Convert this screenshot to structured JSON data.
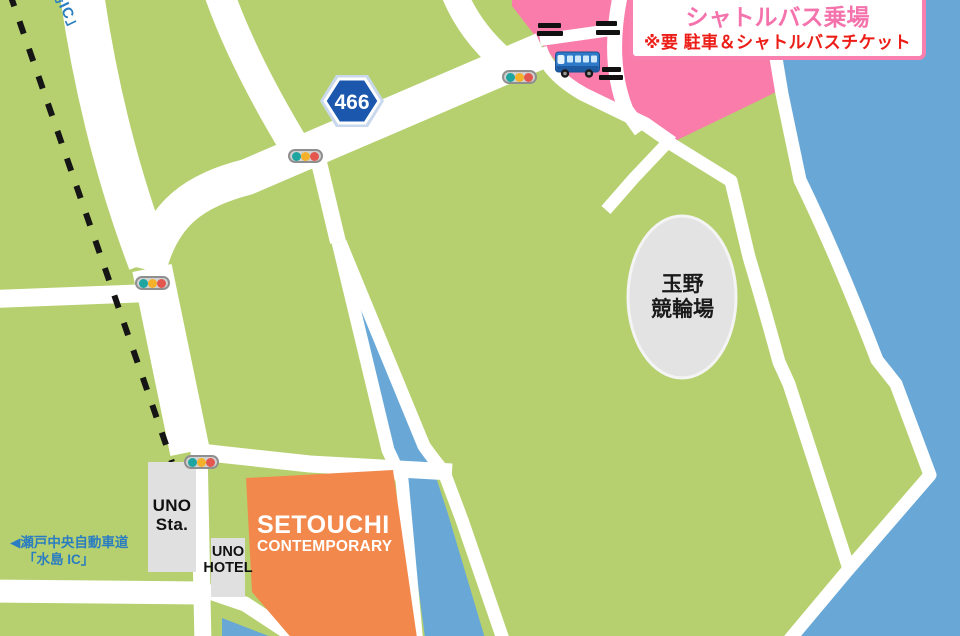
{
  "map": {
    "labels": {
      "route_number": "466",
      "ic_fragment": "島IC」",
      "expressway": {
        "line1": "◀瀬戸中央自動車道",
        "line2": "「水島 IC」"
      },
      "station": {
        "line1": "UNO",
        "line2": "Sta."
      },
      "hotel": {
        "line1": "UNO",
        "line2": "HOTEL"
      },
      "venue": {
        "line1": "SETOUCHI",
        "line2": "CONTEMPORARY"
      },
      "stadium": {
        "line1": "玉野",
        "line2": "競輪場"
      }
    },
    "info_box": {
      "line1": "玉野競輪 駐車場",
      "line2": "シャトルバス乗場",
      "line3": "※要 駐車＆シャトルバスチケット"
    },
    "icons": {
      "traffic_light": "traffic-light-icon",
      "bus": "shuttle-bus-icon",
      "gate": "gate-bars-icon",
      "shield": "route-shield-icon",
      "railway": "railway-dashed-line"
    },
    "colors": {
      "land": "#b6d06f",
      "water": "#69a8d6",
      "parking_area": "#f97cab",
      "venue_building": "#f2884b",
      "road": "#ffffff",
      "heading_pink": "#f573ac",
      "warning_red": "#ec1c16",
      "label_blue": "#2b7dc2",
      "shield_blue": "#1a57ad"
    }
  }
}
